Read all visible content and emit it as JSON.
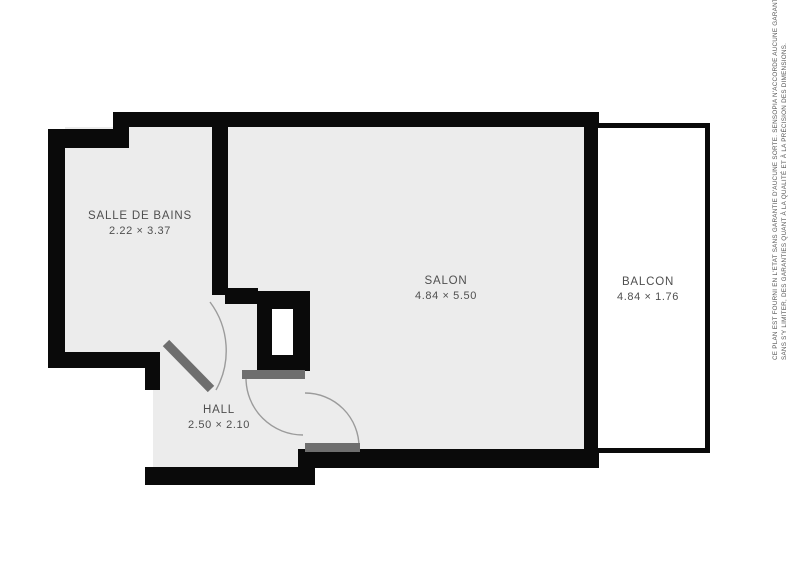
{
  "plan": {
    "rooms": [
      {
        "id": "salle-de-bains",
        "name": "SALLE DE BAINS",
        "dimensions": "2.22 × 3.37"
      },
      {
        "id": "salon",
        "name": "SALON",
        "dimensions": "4.84 × 5.50"
      },
      {
        "id": "hall",
        "name": "HALL",
        "dimensions": "2.50 × 2.10"
      },
      {
        "id": "balcon",
        "name": "BALCON",
        "dimensions": "4.84 × 1.76"
      }
    ],
    "disclaimer": {
      "line1": "CE PLAN EST FOURNI EN L'ETAT SANS GARANTIE D'AUCUNE SORTE. SENSOPIA N'ACCORDE AUCUNE GARANTIE, Y COMPRIS,",
      "line2": "SANS S'Y LIMITER, DES GARANTIES QUANT À LA QUALITÉ ET À LA PRÉCISION DES DIMENSIONS."
    },
    "colors": {
      "wall": "#0a0a0a",
      "floor": "#ececec",
      "door_element": "#6e6e6e",
      "swing_arc": "#9b9b9b",
      "label_text": "#4f4f4f",
      "balcony_fill": "#ffffff",
      "background": "#ffffff"
    }
  }
}
